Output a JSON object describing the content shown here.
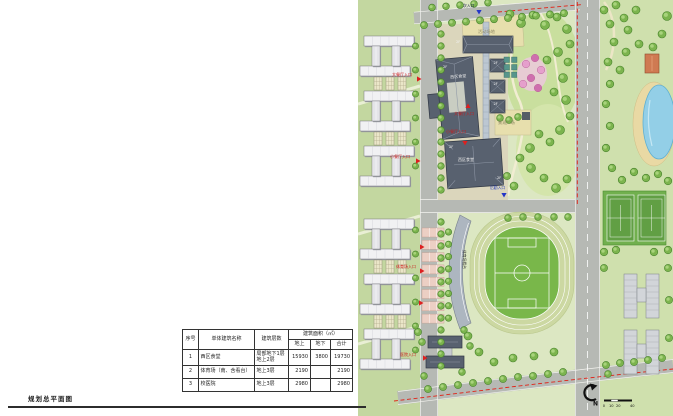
{
  "sheet": {
    "title": "规划总平面图"
  },
  "table": {
    "headers": {
      "no": "序号",
      "name": "单体建筑名称",
      "floors": "建筑层数",
      "area_group": "建筑面积（㎡）",
      "above": "地上",
      "below": "地下",
      "total": "合计"
    },
    "rows": [
      {
        "no": "1",
        "name": "西区食堂",
        "floors": "局部地下1层\n地上2层",
        "above": "15930",
        "below": "3800",
        "total": "19730"
      },
      {
        "no": "2",
        "name": "体育场（南、含看台）",
        "floors": "地上3层",
        "above": "2190",
        "below": "",
        "total": "2190"
      },
      {
        "no": "3",
        "name": "校医院",
        "floors": "地上3层",
        "above": "2980",
        "below": "",
        "total": "2980"
      }
    ]
  },
  "plan": {
    "labels": {
      "secondary_entrance": "次入口",
      "activity_ground": "活动场地",
      "west_canteen": "西区食堂",
      "floor_2f": "2F",
      "main_dining_entrance": "大餐厅入口",
      "small_dining_entrance": "小餐厅入口",
      "landscape_plaza": "景观广场",
      "logistics_entrance": "后勤入口",
      "stadium_entrance": "体育场入口",
      "stadium_stand": "体育场看台",
      "hospital_entrance": "医院入口"
    },
    "compass": {
      "north": "N"
    },
    "scale_ticks": [
      "0",
      "10",
      "20",
      "40"
    ],
    "colors": {
      "red_line": "#e02318",
      "new_roof": "#58616f",
      "lawn": "#cfe0ad",
      "water": "#93cfe7",
      "pitch": "#79b74a",
      "marker_red": "#dd2020",
      "marker_blue": "#2436c8"
    }
  }
}
